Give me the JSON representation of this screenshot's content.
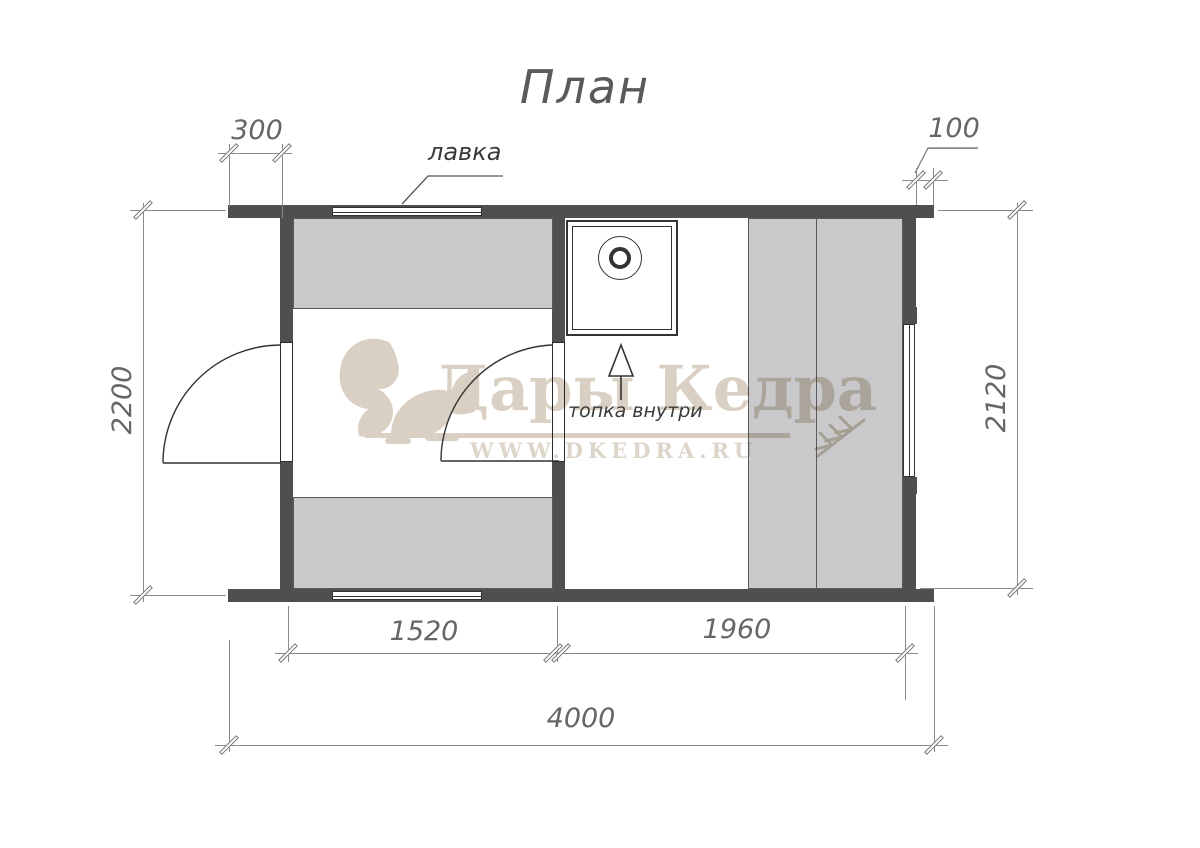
{
  "title": "План",
  "labels": {
    "bench": "лавка",
    "stove": "топка внутри"
  },
  "dimensions": {
    "left_overhang": "300",
    "right_overhang": "100",
    "outer_depth": "2200",
    "inner_depth": "2120",
    "dressing_room_width": "1520",
    "steam_room_width": "1960",
    "total_length": "4000"
  },
  "watermark": {
    "brand": "Дары Кедра",
    "site": "WWW.DKEDRA.RU"
  },
  "colors": {
    "wall": "#4f4f4f",
    "bench_fill": "#c9c9cb",
    "plan_line": "#333333",
    "dim_line": "#8a8a8a",
    "dim_text": "#666666",
    "watermark": "#d9d0c3"
  }
}
